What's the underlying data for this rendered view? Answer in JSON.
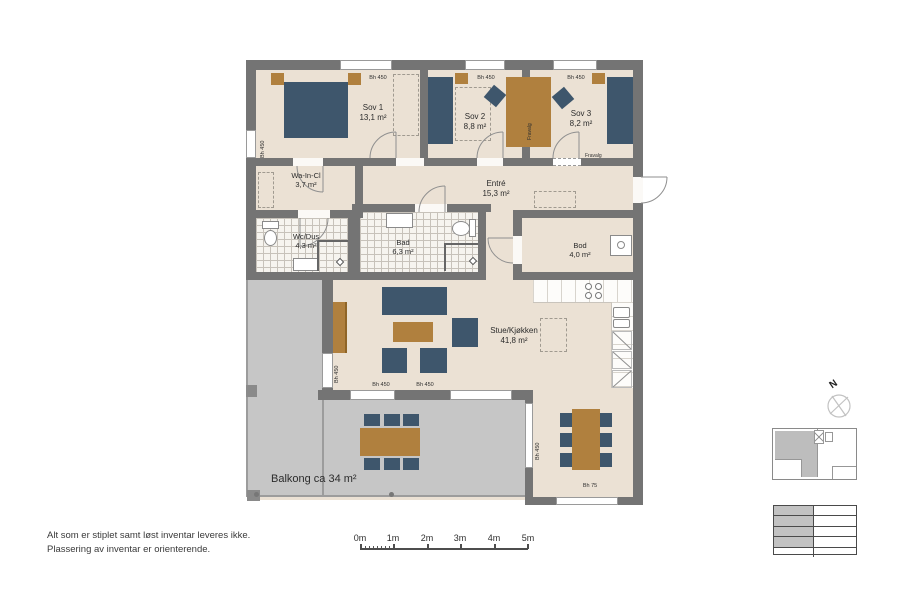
{
  "colors": {
    "floor": "#ebe1d4",
    "wall": "#747474",
    "balcony": "#c6c6c6",
    "furniture_blue": "#3e566c",
    "furniture_wood": "#b0803e"
  },
  "plan": {
    "rooms": {
      "sov1": {
        "name": "Sov 1",
        "area": "13,1 m²"
      },
      "sov2": {
        "name": "Sov 2",
        "area": "8,8 m²"
      },
      "sov3": {
        "name": "Sov 3",
        "area": "8,2 m²"
      },
      "waincl": {
        "name": "Wa-In-Cl",
        "area": "3,7 m²"
      },
      "entre": {
        "name": "Entré",
        "area": "15,3 m²"
      },
      "wcdus": {
        "name": "Wc/Dus",
        "area": "4,3 m²"
      },
      "bad": {
        "name": "Bad",
        "area": "6,3 m²"
      },
      "bod": {
        "name": "Bod",
        "area": "4,0 m²"
      },
      "stue": {
        "name": "Stue/Kjøkken",
        "area": "41,8 m²"
      },
      "balkong": {
        "name": "Balkong ca 34 m²"
      }
    },
    "window_labels": {
      "bh450": "Bh 450",
      "bh75": "Bh 75"
    },
    "option_label": "Fravalg",
    "compass": {
      "north": "N"
    }
  },
  "notes": {
    "line1": "Alt som er stiplet samt løst inventar leveres ikke.",
    "line2": "Plassering av inventar er orienterende."
  },
  "scalebar": {
    "labels": [
      "0m",
      "1m",
      "2m",
      "3m",
      "4m",
      "5m"
    ]
  }
}
